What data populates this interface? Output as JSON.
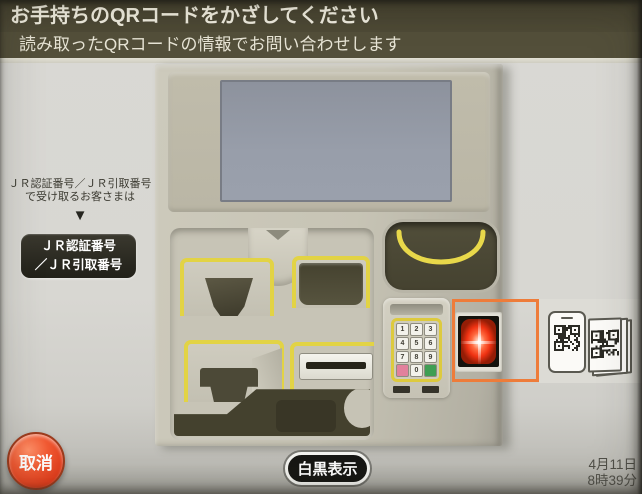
{
  "header": {
    "title": "お手持ちのQRコードをかざしてください",
    "subtitle": "読み取ったQRコードの情報でお問い合わせします"
  },
  "left_panel": {
    "note_line1": "ＪＲ認証番号／ＪＲ引取番号",
    "note_line2": "で受け取るお客さまは",
    "arrow_icon": "▼",
    "jr_button": {
      "line1": "ＪＲ認証番号",
      "line2": "／ＪＲ引取番号"
    }
  },
  "machine": {
    "keypad_keys": [
      {
        "label": "1",
        "type": "num"
      },
      {
        "label": "2",
        "type": "num"
      },
      {
        "label": "3",
        "type": "num"
      },
      {
        "label": "4",
        "type": "num"
      },
      {
        "label": "5",
        "type": "num"
      },
      {
        "label": "6",
        "type": "num"
      },
      {
        "label": "7",
        "type": "num"
      },
      {
        "label": "8",
        "type": "num"
      },
      {
        "label": "9",
        "type": "num"
      },
      {
        "label": "",
        "type": "pink"
      },
      {
        "label": "0",
        "type": "num"
      },
      {
        "label": "",
        "type": "green"
      }
    ]
  },
  "footer": {
    "cancel_label": "取消",
    "bw_label": "白黒表示",
    "date": "4月11日",
    "time": "8時39分"
  },
  "colors": {
    "header_bg": "#4d4936",
    "accent_yellow": "#e2d345",
    "highlight_orange": "#ee7c3a",
    "cancel_red": "#e23e1d",
    "scan_glow_red": "#ef3212",
    "screen_blue_gray": "#989eaa"
  }
}
